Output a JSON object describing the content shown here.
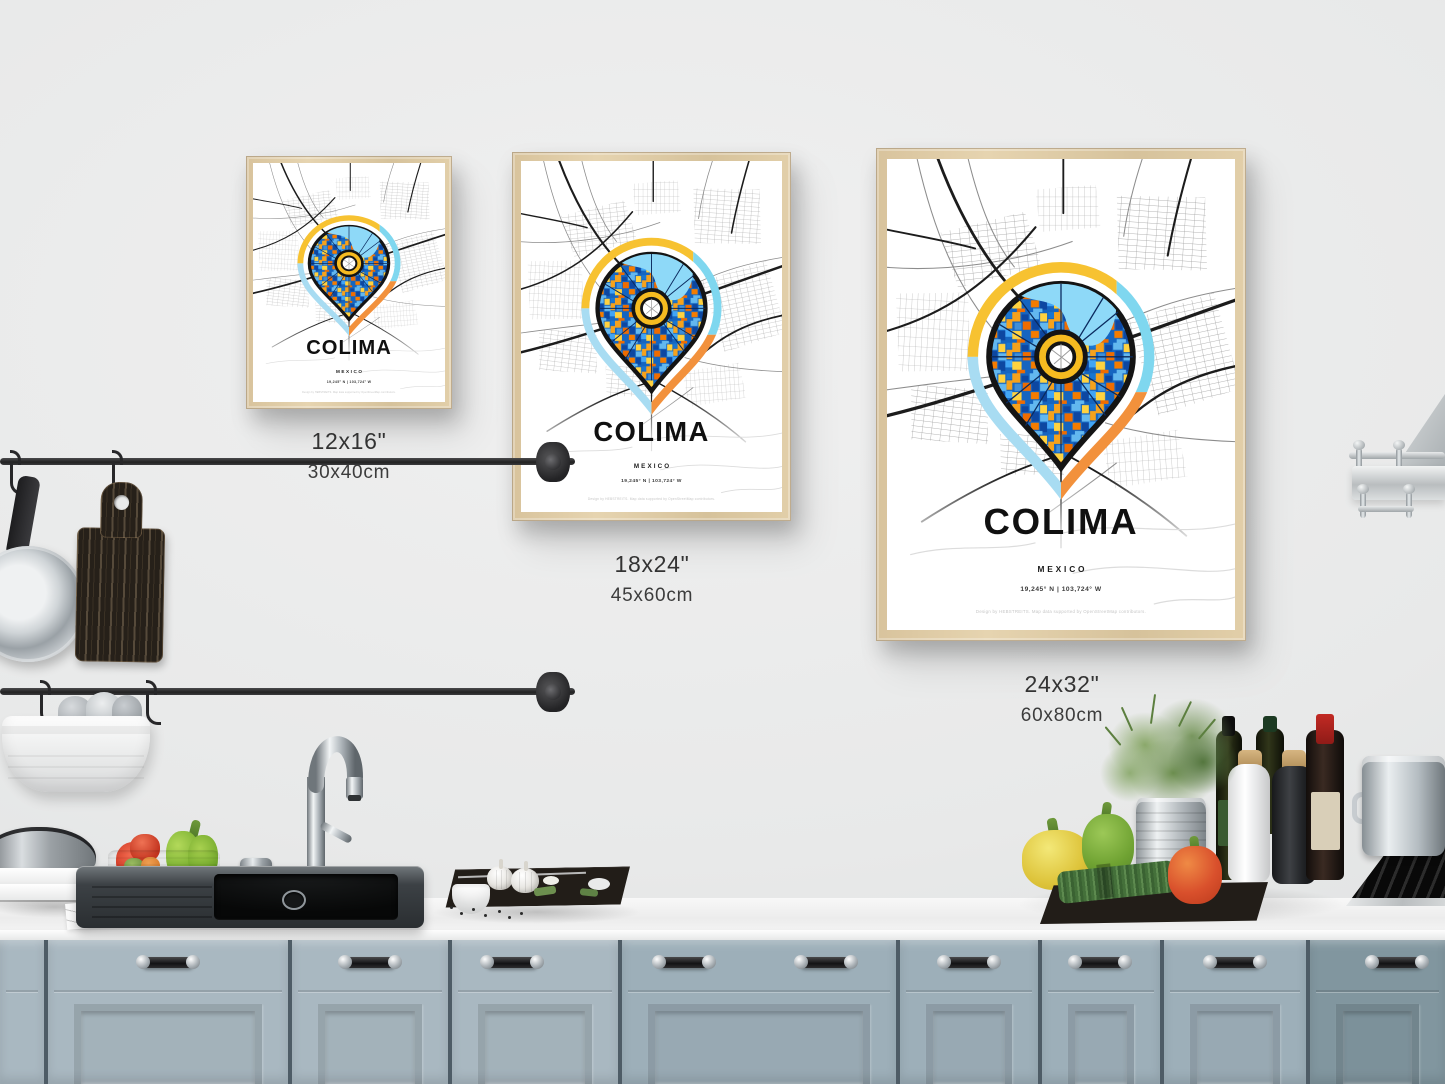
{
  "posters": {
    "small": {
      "city": "COLIMA",
      "country": "MEXICO",
      "coordinates": "19,245° N | 103,724° W",
      "credit": "Design by HEBSTREITS. Map data supported by OpenStreetMap contributors.",
      "size_inches": "12x16\"",
      "size_cm": "30x40cm"
    },
    "medium": {
      "city": "COLIMA",
      "country": "MEXICO",
      "coordinates": "19,245° N | 103,724° W",
      "credit": "Design by HEBSTREITS. Map data supported by OpenStreetMap contributors.",
      "size_inches": "18x24\"",
      "size_cm": "45x60cm"
    },
    "large": {
      "city": "COLIMA",
      "country": "MEXICO",
      "coordinates": "19,245° N | 103,724° W",
      "credit": "Design by HEBSTREITS. Map data supported by OpenStreetMap contributors.",
      "size_inches": "24x32\"",
      "size_cm": "60x80cm"
    }
  },
  "map_palette": {
    "pin_yellow": "#f7c231",
    "pin_cyan": "#7fd7ef",
    "pin_orange": "#f2913c",
    "pin_light_blue": "#a8dcf2",
    "water": "#8ed9f8",
    "donut": "#f6bb20",
    "mosaic_blues": [
      "#0d47a1",
      "#1565c0",
      "#3f8fd8",
      "#63b8ef"
    ],
    "mosaic_warm": [
      "#ef6c00",
      "#f6a21c",
      "#ffd23f"
    ],
    "streets_major": "#1c1c1c",
    "streets_minor": "#8c8c8c"
  },
  "scene_colors": {
    "wall": "#e8e9e9",
    "frame_wood": "#ddc9a4",
    "cabinet_left": "#a9b8c1",
    "cabinet_right": "#81969f",
    "countertop": "#f2f3f3"
  }
}
